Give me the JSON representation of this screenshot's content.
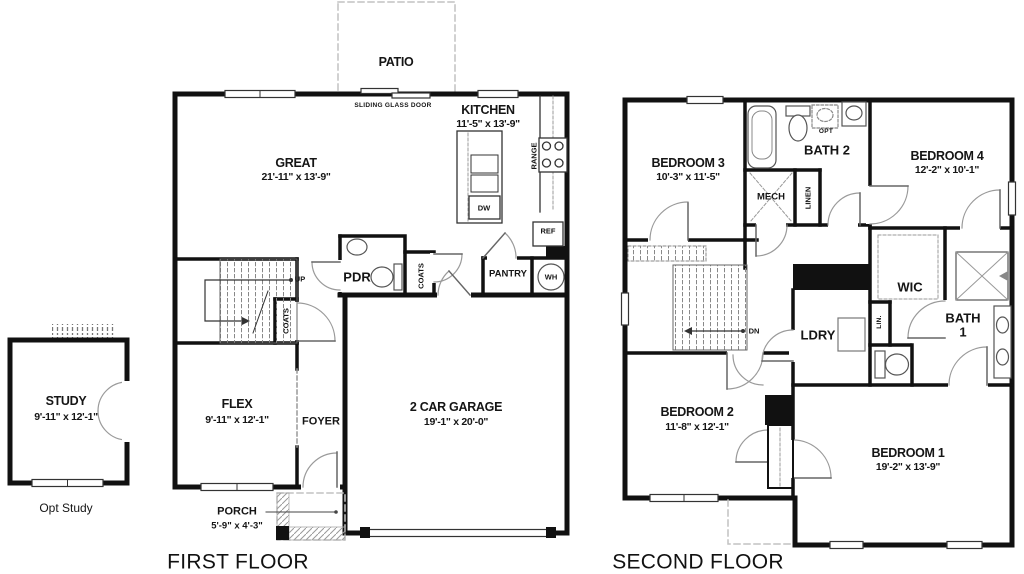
{
  "colors": {
    "wall": "#111111",
    "dashed_outline": "#c2c2c2",
    "background": "#ffffff"
  },
  "first_floor": {
    "title": "FIRST FLOOR",
    "patio": "PATIO",
    "sliding_glass_door": "SLIDING GLASS DOOR",
    "great": {
      "name": "GREAT",
      "dims": "21'-11\" x 13'-9\""
    },
    "kitchen": {
      "name": "KITCHEN",
      "dims": "11'-5\" x 13'-9\""
    },
    "range": "RANGE",
    "dw": "DW",
    "ref": "REF",
    "pdr": "PDR",
    "coats_hall": "COATS",
    "coats_stairs": "COATS",
    "pantry": "PANTRY",
    "wh": "WH",
    "up": "UP",
    "flex": {
      "name": "FLEX",
      "dims": "9'-11\" x 12'-1\""
    },
    "foyer": "FOYER",
    "garage": {
      "name": "2 CAR GARAGE",
      "dims": "19'-1\" x 20'-0\""
    },
    "study": {
      "name": "STUDY",
      "dims": "9'-11\" x 12'-1\""
    },
    "opt_study": "Opt Study",
    "porch": {
      "name": "PORCH",
      "dims": "5'-9\" x 4'-3\""
    }
  },
  "second_floor": {
    "title": "SECOND FLOOR",
    "bedroom3": {
      "name": "BEDROOM 3",
      "dims": "10'-3\" x 11'-5\""
    },
    "bath2": "BATH 2",
    "opt": "OPT",
    "bedroom4": {
      "name": "BEDROOM 4",
      "dims": "12'-2\" x 10'-1\""
    },
    "mech": "MECH",
    "linen": "LINEN",
    "dn": "DN",
    "ldry": "LDRY",
    "wic": "WIC",
    "lin": "LIN.",
    "bath1": {
      "line1": "BATH",
      "line2": "1"
    },
    "bedroom2": {
      "name": "BEDROOM 2",
      "dims": "11'-8\" x 12'-1\""
    },
    "bedroom1": {
      "name": "BEDROOM 1",
      "dims": "19'-2\" x 13'-9\""
    }
  }
}
